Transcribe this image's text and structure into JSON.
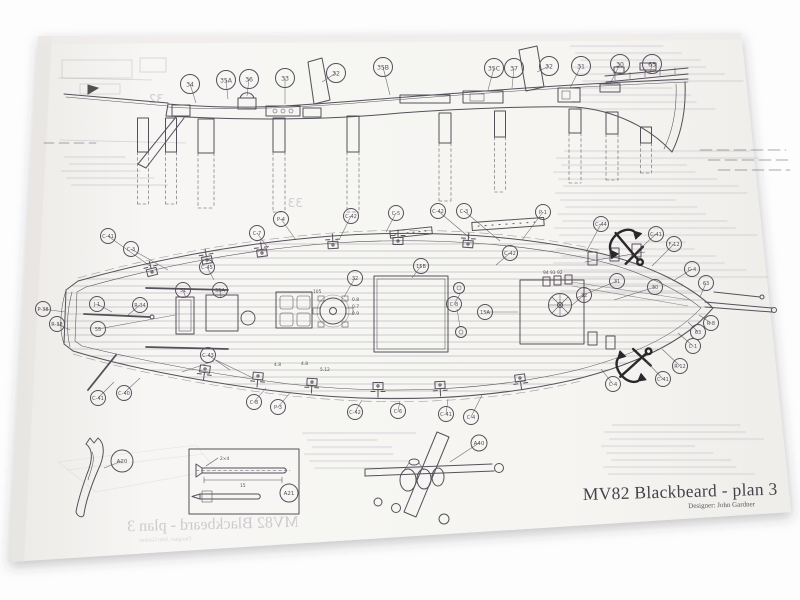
{
  "sheet": {
    "title": "MV82 Blackbeard - plan 3",
    "designer": "Designer: John Gardner"
  },
  "colors": {
    "ink": "#56505a",
    "bold_ink": "#2b272b",
    "paper": "#f6f5f3"
  },
  "callouts": {
    "profile_view": [
      {
        "label": "34",
        "x": 190,
        "y": 84,
        "tx": 196,
        "ty": 103
      },
      {
        "label": "35A",
        "x": 226,
        "y": 80,
        "tx": 228,
        "ty": 99
      },
      {
        "label": "36",
        "x": 249,
        "y": 79,
        "tx": 247,
        "ty": 96
      },
      {
        "label": "33",
        "x": 285,
        "y": 78,
        "tx": 285,
        "ty": 104
      },
      {
        "label": "32",
        "x": 336,
        "y": 73,
        "tx": 322,
        "ty": 82
      },
      {
        "label": "35B",
        "x": 383,
        "y": 67,
        "tx": 390,
        "ty": 95
      },
      {
        "label": "35C",
        "x": 494,
        "y": 68,
        "tx": 488,
        "ty": 90
      },
      {
        "label": "37",
        "x": 514,
        "y": 68,
        "tx": 512,
        "ty": 88
      },
      {
        "label": "32",
        "x": 549,
        "y": 66,
        "tx": 537,
        "ty": 72
      },
      {
        "label": "31",
        "x": 581,
        "y": 66,
        "tx": 570,
        "ty": 88
      },
      {
        "label": "30",
        "x": 620,
        "y": 64,
        "tx": 610,
        "ty": 84
      },
      {
        "label": "63",
        "x": 652,
        "y": 64,
        "tx": 650,
        "ty": 74
      }
    ],
    "deck_plan": [
      {
        "label": "C-41",
        "x": 108,
        "y": 236,
        "tx": 150,
        "ty": 266
      },
      {
        "label": "C-3",
        "x": 131,
        "y": 249,
        "tx": 168,
        "ty": 270
      },
      {
        "label": "C-7",
        "x": 257,
        "y": 233,
        "tx": 268,
        "ty": 248
      },
      {
        "label": "P-4",
        "x": 281,
        "y": 219,
        "tx": 296,
        "ty": 240
      },
      {
        "label": "C-42",
        "x": 351,
        "y": 216,
        "tx": 340,
        "ty": 238
      },
      {
        "label": "C-5",
        "x": 396,
        "y": 213,
        "tx": 386,
        "ty": 232
      },
      {
        "label": "C-42",
        "x": 438,
        "y": 211,
        "tx": 470,
        "ty": 238
      },
      {
        "label": "C-3",
        "x": 464,
        "y": 211,
        "tx": 500,
        "ty": 241
      },
      {
        "label": "P-1",
        "x": 543,
        "y": 212,
        "tx": 522,
        "ty": 240
      },
      {
        "label": "C-44",
        "x": 601,
        "y": 224,
        "tx": 586,
        "ty": 252
      },
      {
        "label": "C-41",
        "x": 656,
        "y": 234,
        "tx": 630,
        "ty": 258
      },
      {
        "label": "F-12",
        "x": 674,
        "y": 244,
        "tx": 652,
        "ty": 266
      },
      {
        "label": "C-4",
        "x": 692,
        "y": 269,
        "tx": 673,
        "ty": 281
      },
      {
        "label": "63",
        "x": 706,
        "y": 283,
        "tx": 700,
        "ty": 297
      },
      {
        "label": "31",
        "x": 617,
        "y": 281,
        "tx": 576,
        "ty": 298
      },
      {
        "label": "30",
        "x": 655,
        "y": 287,
        "tx": 614,
        "ty": 300
      },
      {
        "label": "32",
        "x": 584,
        "y": 295,
        "tx": 571,
        "ty": 306
      },
      {
        "label": "R-8",
        "x": 711,
        "y": 323,
        "tx": 699,
        "ty": 315
      },
      {
        "label": "63",
        "x": 698,
        "y": 332,
        "tx": 688,
        "ty": 322
      },
      {
        "label": "C-1",
        "x": 693,
        "y": 346,
        "tx": 678,
        "ty": 333
      },
      {
        "label": "R-12",
        "x": 680,
        "y": 366,
        "tx": 662,
        "ty": 349
      },
      {
        "label": "C-41",
        "x": 663,
        "y": 379,
        "tx": 646,
        "ty": 361
      },
      {
        "label": "C-4",
        "x": 613,
        "y": 384,
        "tx": 601,
        "ty": 369
      },
      {
        "label": "P-38",
        "x": 43,
        "y": 309,
        "tx": 65,
        "ty": 312
      },
      {
        "label": "R-38",
        "x": 57,
        "y": 324,
        "tx": 70,
        "ty": 330
      },
      {
        "label": "J-1",
        "x": 97,
        "y": 304,
        "tx": 112,
        "ty": 312
      },
      {
        "label": "R-34",
        "x": 140,
        "y": 305,
        "tx": 128,
        "ty": 315
      },
      {
        "label": "55",
        "x": 98,
        "y": 329,
        "tx": 175,
        "ty": 315
      },
      {
        "label": "31",
        "x": 183,
        "y": 290,
        "tx": 186,
        "ty": 298
      },
      {
        "label": "55A",
        "x": 220,
        "y": 290,
        "tx": 221,
        "ty": 298
      },
      {
        "label": "C-45",
        "x": 207,
        "y": 267,
        "tx": 214,
        "ty": 280
      },
      {
        "label": "C-43",
        "x": 208,
        "y": 355,
        "tx": 230,
        "ty": 370
      },
      {
        "label": "C-40",
        "x": 124,
        "y": 393,
        "tx": 140,
        "ty": 378
      },
      {
        "label": "C-41",
        "x": 98,
        "y": 398,
        "tx": 114,
        "ty": 382
      },
      {
        "label": "C-8",
        "x": 254,
        "y": 402,
        "tx": 266,
        "ty": 388
      },
      {
        "label": "P-3",
        "x": 278,
        "y": 407,
        "tx": 290,
        "ty": 393
      },
      {
        "label": "C-42",
        "x": 355,
        "y": 412,
        "tx": 362,
        "ty": 400
      },
      {
        "label": "C-6",
        "x": 398,
        "y": 411,
        "tx": 400,
        "ty": 401
      },
      {
        "label": "C-41",
        "x": 446,
        "y": 414,
        "tx": 448,
        "ty": 399
      },
      {
        "label": "C-4",
        "x": 471,
        "y": 417,
        "tx": 482,
        "ty": 395
      },
      {
        "label": "15B",
        "x": 421,
        "y": 266,
        "tx": 412,
        "ty": 278
      },
      {
        "label": "15A",
        "x": 485,
        "y": 312,
        "tx": 518,
        "ty": 312
      },
      {
        "label": "C-8",
        "x": 454,
        "y": 304,
        "tx": 460,
        "ty": 294
      },
      {
        "label": "32",
        "x": 355,
        "y": 278,
        "tx": 344,
        "ty": 297
      },
      {
        "label": "C-42",
        "x": 510,
        "y": 253,
        "tx": 496,
        "ty": 265
      }
    ],
    "details": [
      {
        "label": "A20",
        "x": 122,
        "y": 461,
        "r": 11,
        "tx": 104,
        "ty": 468
      },
      {
        "label": "A21",
        "x": 289,
        "y": 493,
        "r": 9
      },
      {
        "label": "A40",
        "x": 479,
        "y": 443,
        "r": 8,
        "tx": 450,
        "ty": 462
      }
    ]
  },
  "annotations": [
    {
      "text": "94 93 92",
      "x": 543,
      "y": 274
    },
    {
      "text": "105",
      "x": 313,
      "y": 293
    },
    {
      "text": "0.8",
      "x": 352,
      "y": 301
    },
    {
      "text": "0.7",
      "x": 352,
      "y": 308
    },
    {
      "text": "0.9",
      "x": 352,
      "y": 315
    },
    {
      "text": "4.8",
      "x": 274,
      "y": 366
    },
    {
      "text": "4.8",
      "x": 301,
      "y": 365
    },
    {
      "text": "5.12",
      "x": 320,
      "y": 371
    },
    {
      "text": "2×4",
      "x": 220,
      "y": 460
    },
    {
      "text": "15",
      "x": 240,
      "y": 487
    }
  ],
  "ghost_showthrough": {
    "numbers": [
      {
        "text": "33",
        "x": 303,
        "y": 207,
        "size": 12
      },
      {
        "text": "32",
        "x": 164,
        "y": 103,
        "size": 12
      }
    ]
  }
}
